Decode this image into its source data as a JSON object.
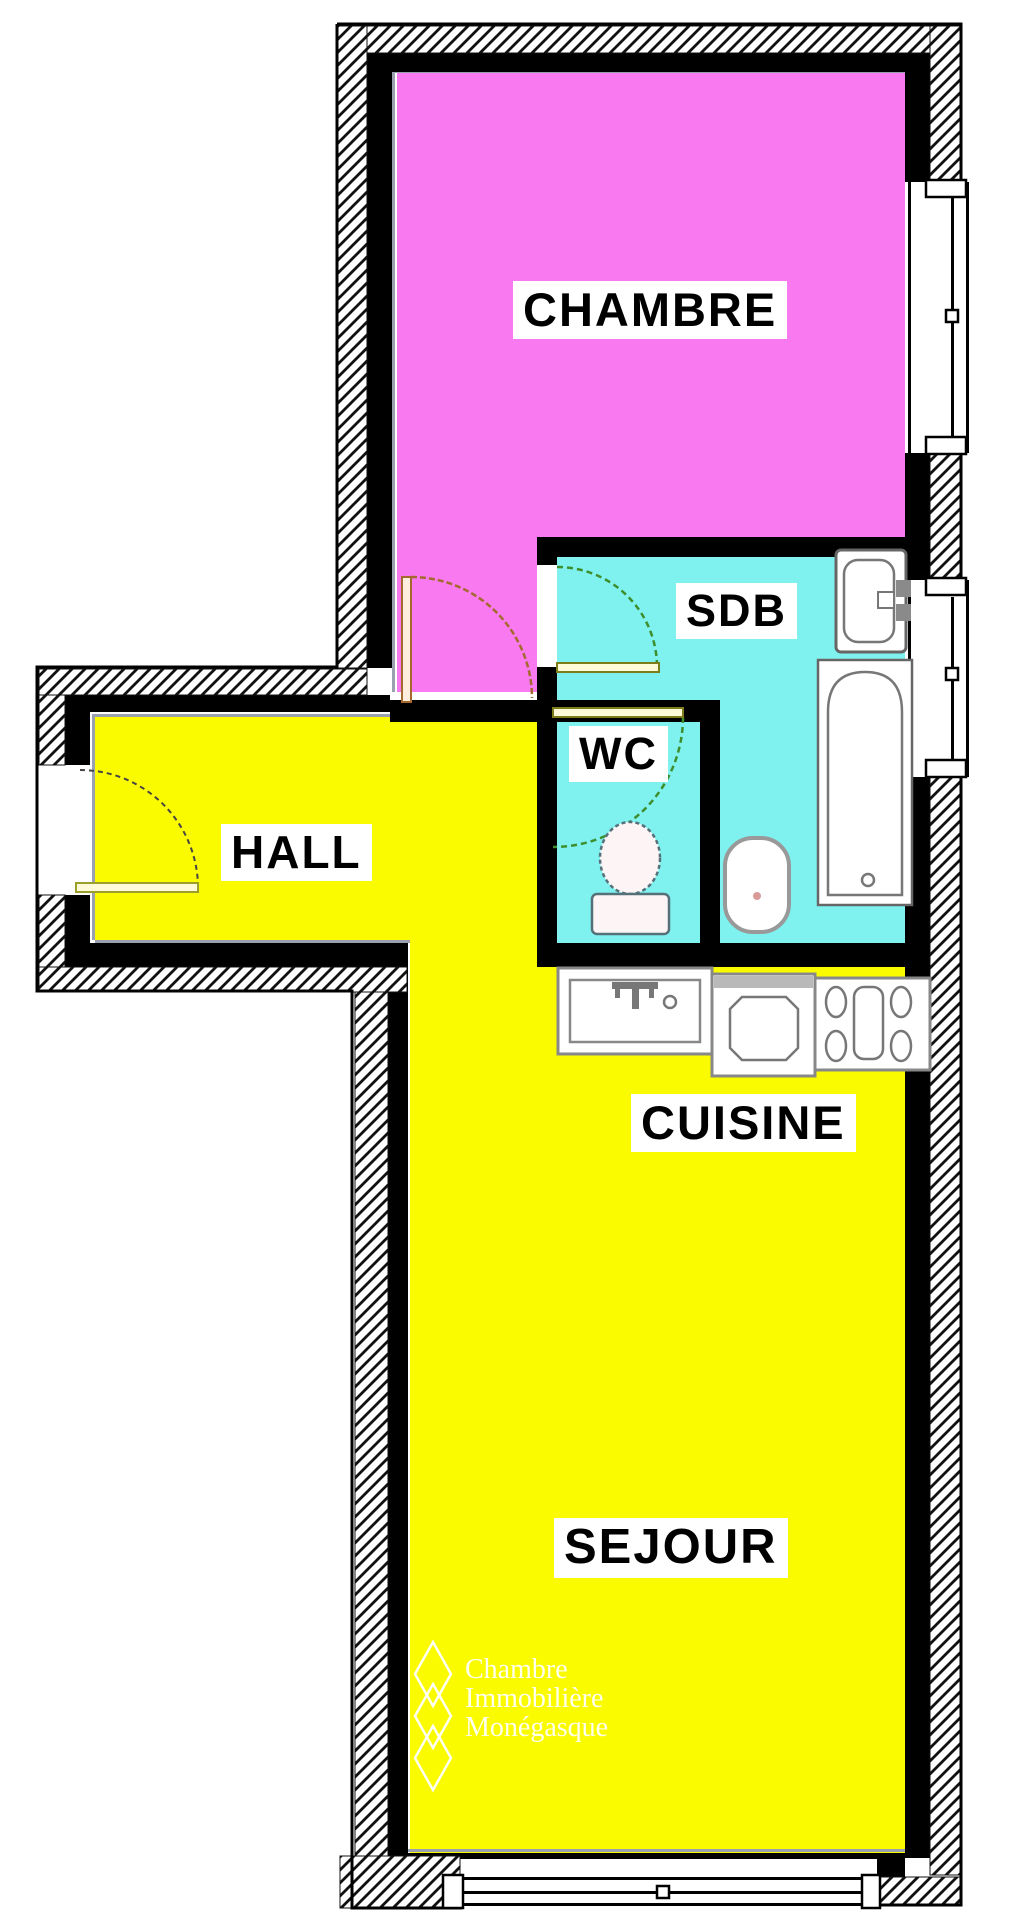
{
  "plan": {
    "title": "apartment-floor-plan",
    "rooms": [
      {
        "id": "chambre",
        "label": "CHAMBRE",
        "color": "#f97af0"
      },
      {
        "id": "sdb",
        "label": "SDB",
        "color": "#7ff2f0"
      },
      {
        "id": "wc",
        "label": "WC",
        "color": "#7ff2f0"
      },
      {
        "id": "hall",
        "label": "HALL",
        "color": "#fbfb00"
      },
      {
        "id": "cuisine",
        "label": "CUISINE",
        "color": "#fbfb00"
      },
      {
        "id": "sejour",
        "label": "SEJOUR",
        "color": "#fbfb00"
      }
    ],
    "colors": {
      "wall": "#000000",
      "bedroom_fill": "#f97af0",
      "bath_fill": "#7ff2f0",
      "living_fill": "#fbfb00",
      "door_arc_green": "#3e8e2e",
      "door_arc_brown": "#a5692f",
      "door_leaf_olive": "#7d7d1a",
      "fixture_outline": "#808080",
      "accent_line": "#9aa0b0"
    },
    "fixtures": [
      "washbasin",
      "bathtub",
      "toilet",
      "bidet",
      "kitchen-sink",
      "oven",
      "cooktop"
    ],
    "windows": [
      "chambre-window",
      "sdb-window",
      "sejour-window"
    ],
    "doors": [
      "entrance-door",
      "chambre-door",
      "sdb-door",
      "wc-door"
    ],
    "watermark": {
      "lines": [
        "Chambre",
        "Immobilière",
        "Monégasque"
      ]
    }
  }
}
